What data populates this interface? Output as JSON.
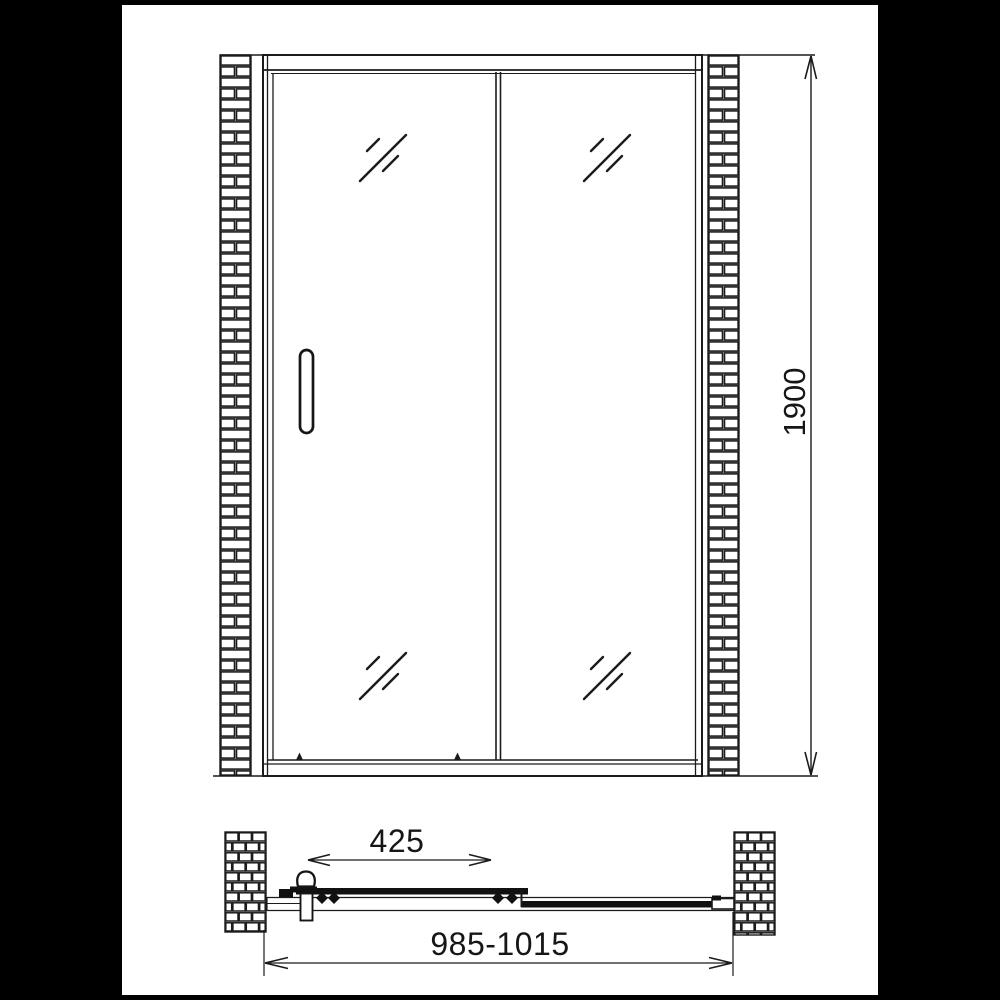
{
  "drawing": {
    "kind": "shower sliding door technical drawing",
    "dimensions": {
      "height_mm": "1900",
      "door_opening_mm": "425",
      "overall_width_mm": "985-1015"
    },
    "colors": {
      "line": "#1b1b1b",
      "background": "#ffffff",
      "letterbox": "#000000"
    }
  }
}
